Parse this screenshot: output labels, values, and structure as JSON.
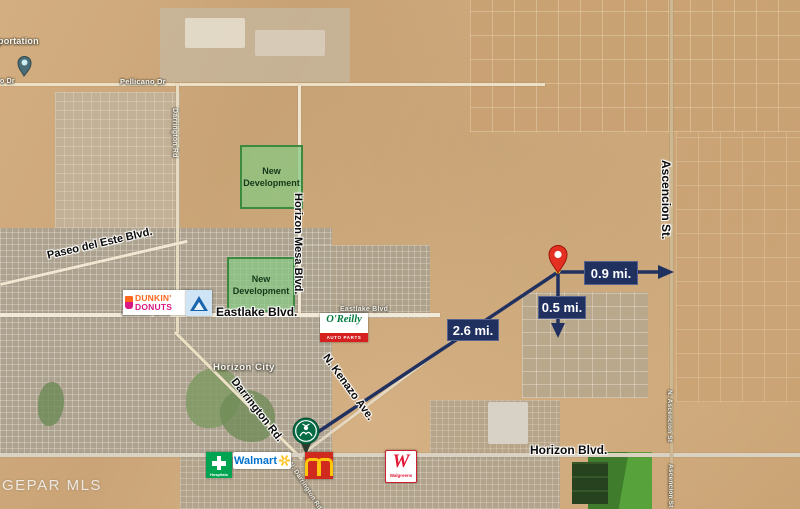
{
  "watermark": "GEPAR MLS",
  "colors": {
    "annotation_navy": "#20305f",
    "pin_red": "#e33022",
    "transit_pin_teal": "#4b6d78",
    "development_green_fill": "#86c982",
    "development_green_border": "#3c8a40",
    "walmart_blue": "#0071ce",
    "walmart_spark_yellow": "#ffc220",
    "mcdonalds_red": "#d02a1e",
    "mcdonalds_arches_yellow": "#ffc60b",
    "walgreens_red": "#e31837",
    "starbucks_green": "#056c45",
    "oreilly_green": "#007a3d",
    "oreilly_red": "#d6201f",
    "dunkin_orange": "#ff671f",
    "dunkin_pink": "#da1884",
    "hospital_green": "#00a451"
  },
  "annotations": {
    "road_labels": {
      "paseo": "Paseo del Este Blvd.",
      "horizon_mesa": "Horizon Mesa Blvd.",
      "eastlake": "Eastlake Blvd.",
      "ascencion": "Ascencion St.",
      "horizon": "Horizon Blvd.",
      "darrington": "Darrington Rd.",
      "kenazo": "N. Kenazo Ave."
    },
    "developments": {
      "north": "New Development",
      "south": "New Development"
    },
    "distances": {
      "east": "0.9 mi.",
      "south": "0.5 mi.",
      "southwest": "2.6 mi."
    }
  },
  "map_labels": {
    "transportation_fragment": "portation",
    "pellicano": "Pellicano Dr",
    "pellicano_fragment": "o Dr",
    "darrington_native": "Darrington Rd",
    "horizon_city": "Horizon City",
    "eastlake_native_west": "Eastlake Blvd",
    "eastlake_native_east": "Eastlake Blvd",
    "n_darrington_native": "N. Darrington Rd",
    "n_ascencion_native": "N. Ascencion St",
    "ascencion_native": "Ascencion St"
  },
  "logos": {
    "dunkin": {
      "line1": "DUNKIN'",
      "line2": "DONUTS"
    },
    "oreilly": {
      "name": "O'Reilly",
      "sub": "AUTO PARTS"
    },
    "hospital": {
      "sub": "Hospitals"
    },
    "walmart": {
      "name": "Walmart"
    },
    "walgreens": {
      "initial": "W",
      "name": "Walgreens"
    },
    "mcdonalds": {
      "icon": "golden-arches-icon"
    },
    "starbucks": {
      "icon": "starbucks-siren-icon"
    },
    "blue_triangle": {
      "icon": "blue-triangle-logo-icon"
    }
  }
}
